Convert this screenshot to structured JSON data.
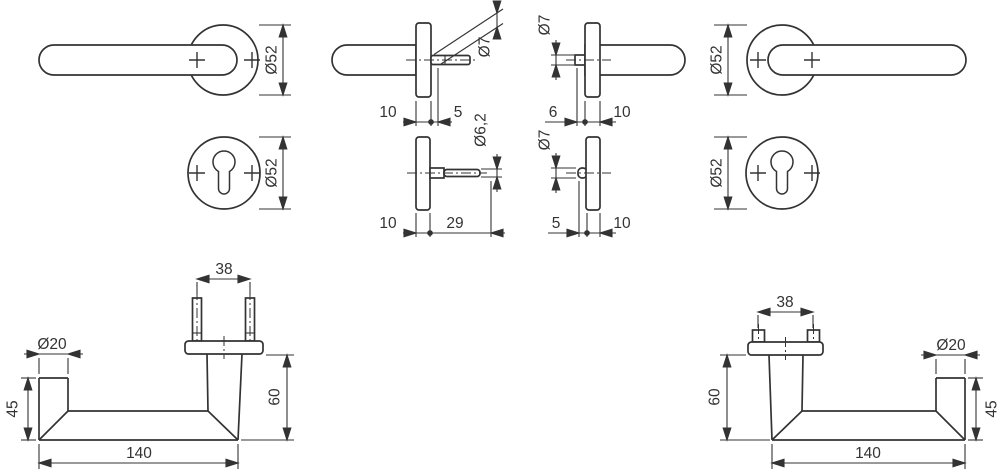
{
  "figures": {
    "handle_front_left": {
      "rose_dia": "Ø52"
    },
    "escutcheon_front_left": {
      "rose_dia": "Ø52"
    },
    "handle_side_left": {
      "spindle_dia": "Ø7",
      "rose_depth": "10",
      "spindle_len": "5"
    },
    "escutcheon_side_left": {
      "pin_dia": "Ø6,2",
      "rose_depth": "10",
      "pin_len": "29"
    },
    "handle_side_right": {
      "pin_dia": "Ø7",
      "pin_len": "6",
      "rose_depth": "10"
    },
    "escutcheon_side_right": {
      "pin_dia": "Ø7",
      "pin_len": "5",
      "rose_depth": "10"
    },
    "handle_front_right": {
      "rose_dia": "Ø52"
    },
    "escutcheon_front_right": {
      "rose_dia": "Ø52"
    },
    "handle_top_left": {
      "stud_spacing": "38",
      "grip_dia": "Ø20",
      "end_height": "45",
      "neck_height": "60",
      "length": "140"
    },
    "handle_top_right": {
      "stud_spacing": "38",
      "grip_dia": "Ø20",
      "end_height": "45",
      "neck_height": "60",
      "length": "140"
    }
  },
  "colors": {
    "line": "#333333",
    "background": "#ffffff"
  }
}
